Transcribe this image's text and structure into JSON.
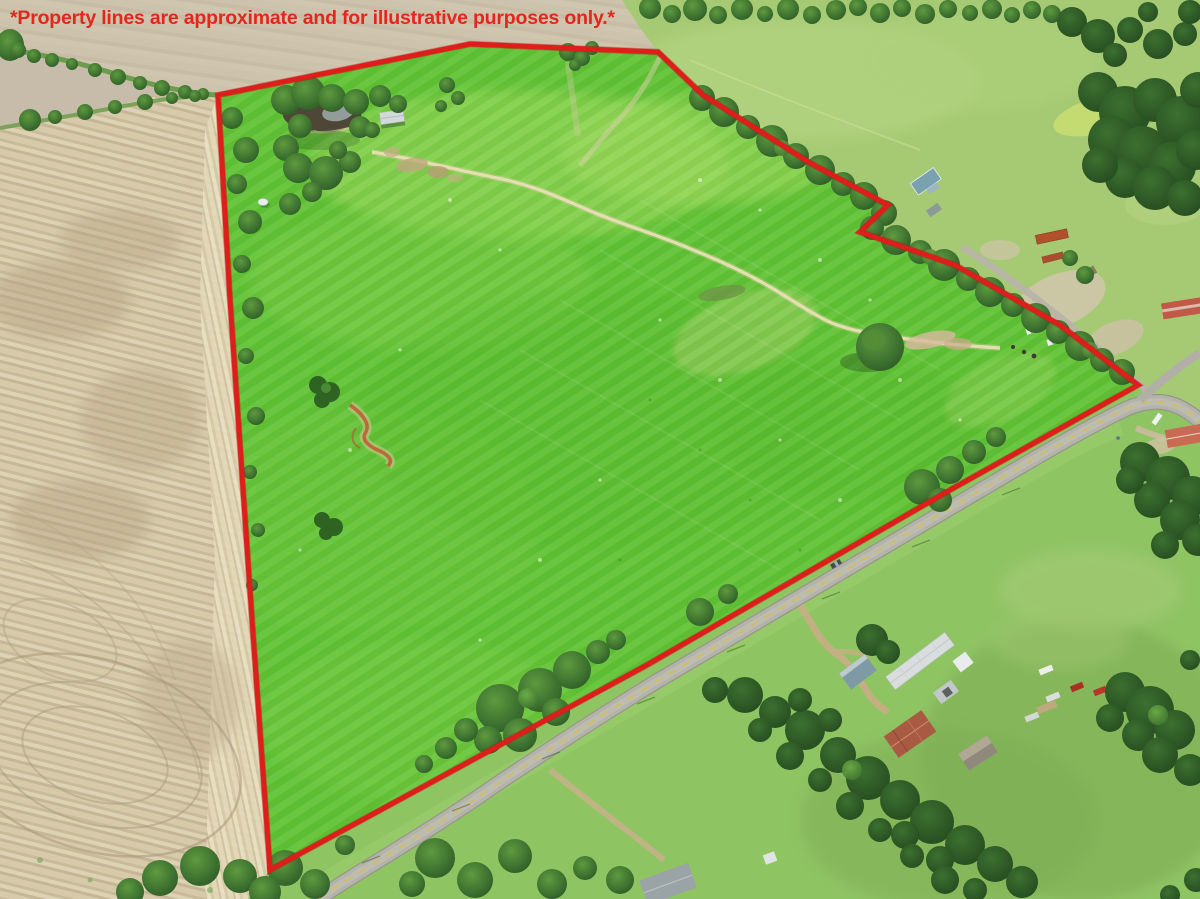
{
  "overlay": {
    "disclaimer": "*Property lines are approximate and for illustrative purposes only.*",
    "disclaimer_color": "#e3271c",
    "boundary_color": "#de1e1a"
  },
  "scene": {
    "description": "Aerial drone photo of a green pasture parcel outlined in red; plowed tan field to the west, county road and homesteads to the southeast, wooded fence lines and neighboring pasture to the northeast",
    "features": [
      "plowed-field",
      "property-pasture",
      "pond",
      "barn",
      "dirt-trail",
      "erosion-gully",
      "lone-tree",
      "county-road",
      "side-road",
      "homestead-south",
      "homestead-northeast",
      "shipping-containers",
      "junk-cars",
      "tree-lines"
    ],
    "palette": {
      "plowed_field": "#d2c6a6",
      "property_grass": "#61c335",
      "neighbor_pasture": "#a6ca74",
      "road": "#b4b3a9",
      "tree_dark": "#2d5d26",
      "pond_water": "#4e4636",
      "dirt_trail": "#e9deb4",
      "erosion_dirt": "#c05f35"
    }
  }
}
